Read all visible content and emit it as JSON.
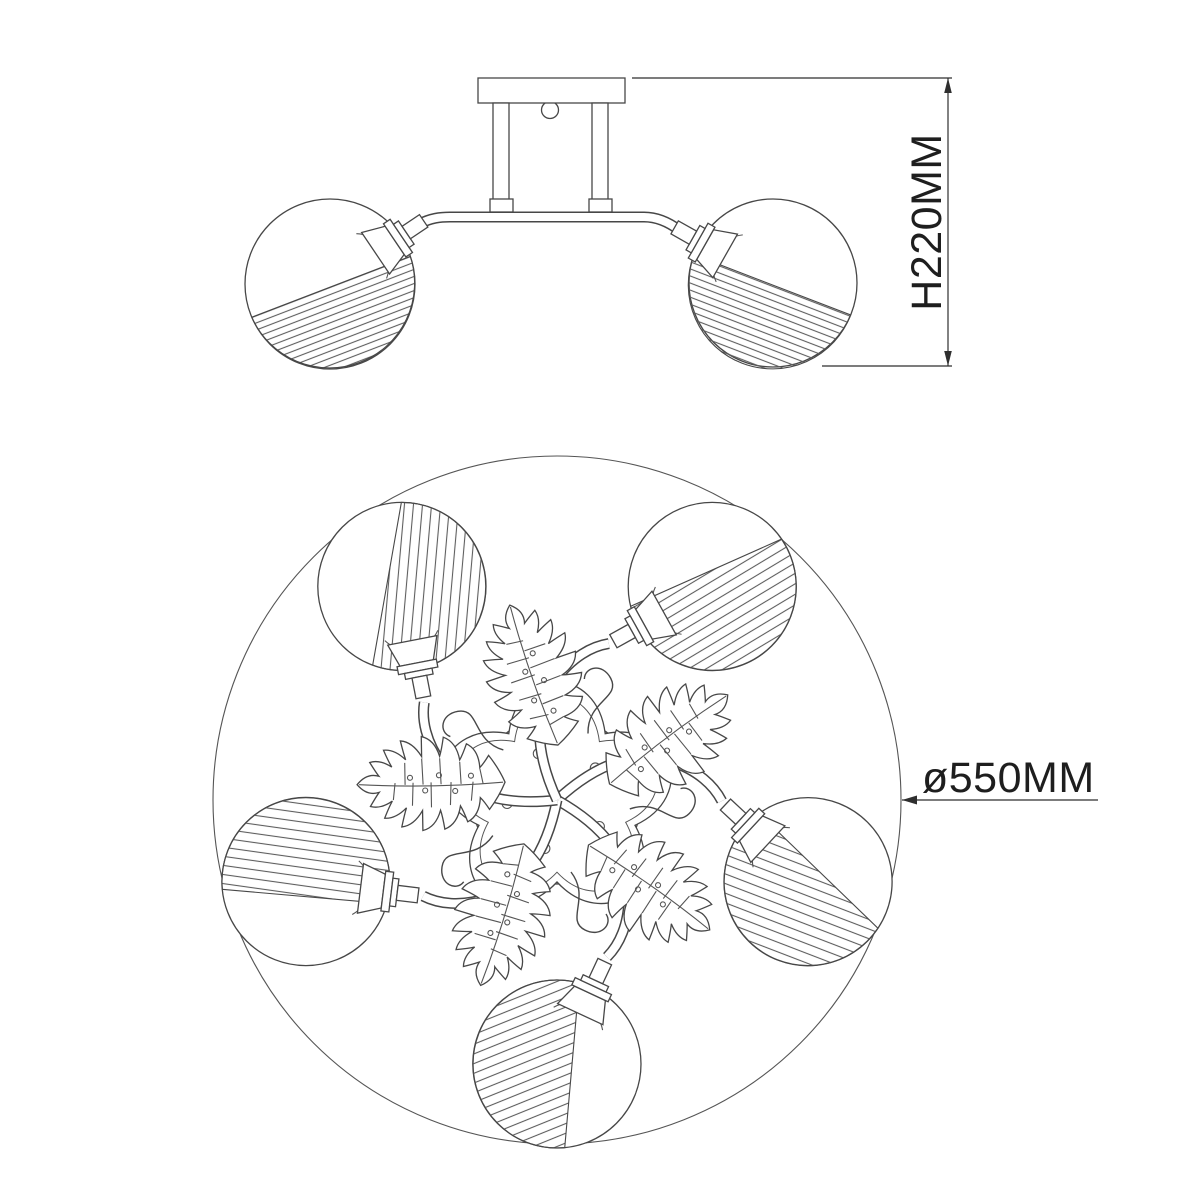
{
  "drawing": {
    "dimensions": {
      "height": "H220MM",
      "diameter": "ø550MM"
    },
    "shade_count": 5,
    "leaf_count": 5,
    "colors": {
      "background": "#ffffff",
      "line": "#474747",
      "dimension_line": "#2f2f2f",
      "text": "#1e1e1e"
    }
  }
}
